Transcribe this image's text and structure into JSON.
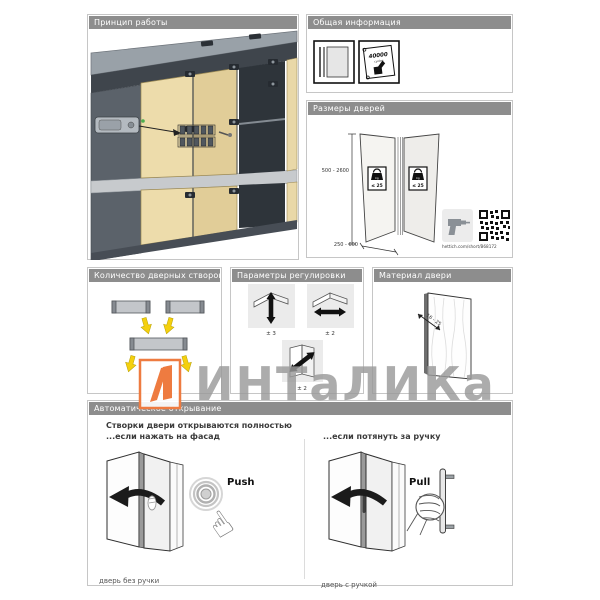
{
  "watermark": {
    "text": "ИНТаЛИКа"
  },
  "panels": {
    "principle": {
      "title": "Принцип работы"
    },
    "general_info": {
      "title": "Общая информация",
      "cycles_value": "40000",
      "cycles_unit": "cycles"
    },
    "door_dimensions": {
      "title": "Размеры дверей",
      "height_range": "500 - 2600",
      "width_range": "250 - 600",
      "weight_limit": "≤ 25",
      "weight_unit": "kg",
      "link": "hettich.com/short/B68172"
    },
    "leaf_count": {
      "title": "Количество дверных створок"
    },
    "adjustment": {
      "title": "Параметры регулировки",
      "vertical": "± 3",
      "horizontal": "± 2",
      "diagonal": "± 2"
    },
    "door_material": {
      "title": "Материал двери",
      "thickness": "16 - 25"
    },
    "auto_opening": {
      "title": "Автоматическое открывание",
      "heading": "Створки двери открываются полностью",
      "push_subheading": "...если нажать на фасад",
      "pull_subheading": "...если потянуть за ручку",
      "push_label": "Push",
      "pull_label": "Pull",
      "no_handle_caption": "дверь без ручки",
      "handle_caption": "дверь с ручкой"
    }
  }
}
